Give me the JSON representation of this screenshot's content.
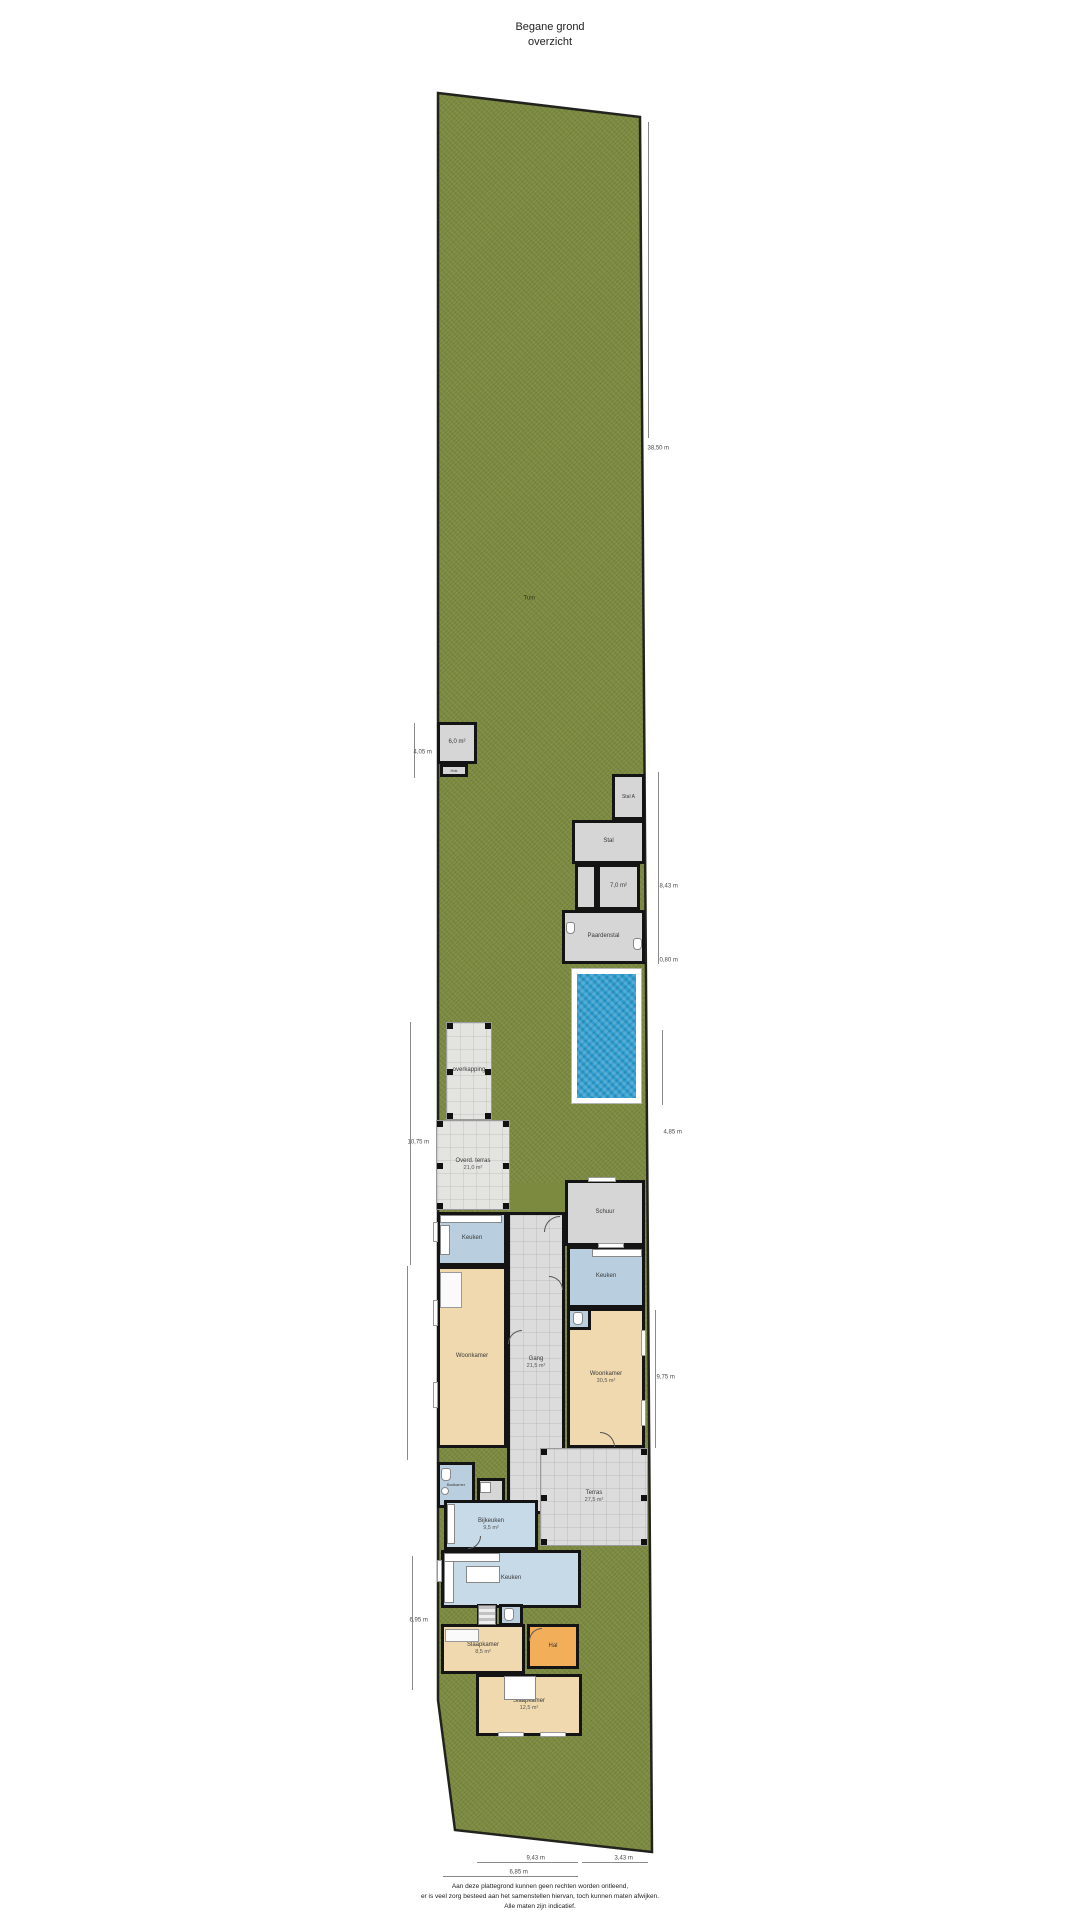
{
  "title": {
    "line1": "Begane grond",
    "line2": "overzicht"
  },
  "disclaimer": {
    "line1": "Aan deze plattegrond kunnen geen rechten worden ontleend,",
    "line2": "er is veel zorg besteed aan het samenstellen hiervan, toch kunnen maten afwijken.",
    "line3": "Alle maten zijn indicatief."
  },
  "colors": {
    "grass": "#7b8a3f",
    "water": "#2f9fd0",
    "wall": "#141414",
    "tan": "#f0d9ae",
    "blue": "#b9cfdf",
    "blueLight": "#c6dae8",
    "orange": "#f2ae58",
    "gray": "#d6d6d6",
    "tile": "#dcdcdc",
    "deck": "#ffffff"
  },
  "plot": {
    "points": "438,93 640,117 652,1852 455,1830 438,1700",
    "clip": "polygon(438px 93px, 640px 117px, 652px 1852px, 455px 1830px, 438px 1700px)"
  },
  "garden_label": {
    "text": "Tuin",
    "x": 524,
    "y": 596
  },
  "pool": {
    "n": "zwembad",
    "x": 571,
    "y": 968,
    "w": 71,
    "h": 136
  },
  "patches": [
    {
      "n": "gras-binnenplaats",
      "x": 511,
      "y": 1183,
      "w": 54,
      "h": 32
    }
  ],
  "verandas": [
    {
      "n": "overkapping",
      "x": 446,
      "y": 1022,
      "w": 46,
      "h": 98,
      "l1": "overkapping"
    },
    {
      "n": "overdekt-terras",
      "x": 436,
      "y": 1120,
      "w": 74,
      "h": 90,
      "l1": "Overd. terras",
      "l2": "21,0 m²"
    }
  ],
  "rooms": [
    {
      "n": "schuur-klein",
      "f": "gray",
      "x": 437,
      "y": 722,
      "w": 40,
      "h": 42,
      "l1": "6,0 m²"
    },
    {
      "n": "hok-klein",
      "f": "gray",
      "x": 440,
      "y": 764,
      "w": 28,
      "h": 13,
      "l1": "Hok",
      "fs": 4
    },
    {
      "n": "stal-a",
      "f": "gray",
      "x": 612,
      "y": 774,
      "w": 33,
      "h": 46,
      "l1": "Stal A",
      "fs": 5
    },
    {
      "n": "stal-b",
      "f": "gray",
      "x": 572,
      "y": 820,
      "w": 73,
      "h": 44,
      "l1": "Stal"
    },
    {
      "n": "hok-1",
      "f": "gray",
      "x": 575,
      "y": 864,
      "w": 22,
      "h": 46
    },
    {
      "n": "hok-2",
      "f": "gray",
      "x": 597,
      "y": 864,
      "w": 43,
      "h": 46,
      "l1": "7,0 m²"
    },
    {
      "n": "paardenstal",
      "f": "gray",
      "x": 562,
      "y": 910,
      "w": 83,
      "h": 54,
      "l1": "Paardenstal"
    },
    {
      "n": "schuur-achter",
      "f": "gray",
      "x": 565,
      "y": 1180,
      "w": 80,
      "h": 66,
      "l1": "Schuur"
    },
    {
      "n": "keuken-links",
      "f": "blue",
      "x": 437,
      "y": 1212,
      "w": 70,
      "h": 54,
      "l1": "Keuken"
    },
    {
      "n": "woonkamer-links",
      "f": "tan",
      "x": 437,
      "y": 1266,
      "w": 70,
      "h": 182,
      "l1": "Woonkamer"
    },
    {
      "n": "gang",
      "f": "tile",
      "t": "tilebg",
      "x": 507,
      "y": 1212,
      "w": 58,
      "h": 302,
      "l1": "Gang",
      "l2": "21,5 m²"
    },
    {
      "n": "keuken-rechts",
      "f": "blue",
      "x": 567,
      "y": 1246,
      "w": 78,
      "h": 62,
      "l1": "Keuken"
    },
    {
      "n": "woonkamer-rechts",
      "f": "tan",
      "x": 567,
      "y": 1308,
      "w": 78,
      "h": 140,
      "l1": "Woonkamer",
      "l2": "30,5 m²"
    },
    {
      "n": "toilet-rechts",
      "f": "blue",
      "x": 567,
      "y": 1308,
      "w": 24,
      "h": 22
    },
    {
      "n": "badkamer-links",
      "f": "blue",
      "x": 437,
      "y": 1462,
      "w": 38,
      "h": 46,
      "l1": "Badkamer",
      "fs": 4
    },
    {
      "n": "kast-cv",
      "f": "gray",
      "x": 477,
      "y": 1478,
      "w": 28,
      "h": 30
    },
    {
      "n": "bijkeuken",
      "f": "blueLight",
      "x": 444,
      "y": 1500,
      "w": 94,
      "h": 50,
      "l1": "Bijkeuken",
      "l2": "9,5 m²"
    },
    {
      "n": "terras-achter",
      "f": "tile",
      "t": "tilebg",
      "x": 540,
      "y": 1448,
      "w": 108,
      "h": 98,
      "l1": "Terras",
      "l2": "27,5 m²",
      "thin": true,
      "posts": true
    },
    {
      "n": "keuken-onder",
      "f": "blueLight",
      "x": 441,
      "y": 1550,
      "w": 140,
      "h": 58,
      "l1": "Keuken"
    },
    {
      "n": "trap-kamer",
      "f": "tile",
      "x": 477,
      "y": 1604,
      "w": 20,
      "h": 22
    },
    {
      "n": "toilet-onder",
      "f": "blue",
      "x": 499,
      "y": 1604,
      "w": 24,
      "h": 22
    },
    {
      "n": "slaapkamer-1",
      "f": "tan",
      "x": 441,
      "y": 1624,
      "w": 84,
      "h": 50,
      "l1": "Slaapkamer",
      "l2": "8,5 m²"
    },
    {
      "n": "hal",
      "f": "orange",
      "x": 527,
      "y": 1624,
      "w": 52,
      "h": 45,
      "l1": "Hal"
    },
    {
      "n": "slaapkamer-2",
      "f": "tan",
      "x": 476,
      "y": 1674,
      "w": 106,
      "h": 62,
      "l1": "Slaapkamer",
      "l2": "12,5 m²"
    }
  ],
  "fixtures": [
    {
      "k": "counter",
      "x": 440,
      "y": 1215,
      "w": 62,
      "h": 8
    },
    {
      "k": "counter",
      "x": 440,
      "y": 1225,
      "w": 10,
      "h": 30
    },
    {
      "k": "counter",
      "x": 592,
      "y": 1249,
      "w": 50,
      "h": 8
    },
    {
      "k": "counter",
      "x": 447,
      "y": 1504,
      "w": 8,
      "h": 40
    },
    {
      "k": "counter",
      "x": 444,
      "y": 1553,
      "w": 10,
      "h": 50
    },
    {
      "k": "counter",
      "x": 444,
      "y": 1553,
      "w": 56,
      "h": 9
    },
    {
      "k": "island",
      "x": 466,
      "y": 1566,
      "w": 34,
      "h": 17
    },
    {
      "k": "wc",
      "x": 573,
      "y": 1312,
      "w": 10,
      "h": 13
    },
    {
      "k": "wc",
      "x": 441,
      "y": 1468,
      "w": 10,
      "h": 13
    },
    {
      "k": "sink",
      "x": 441,
      "y": 1487,
      "w": 8,
      "h": 8
    },
    {
      "k": "wc",
      "x": 504,
      "y": 1608,
      "w": 10,
      "h": 13
    },
    {
      "k": "wc",
      "x": 566,
      "y": 922,
      "w": 9,
      "h": 12
    },
    {
      "k": "wc",
      "x": 633,
      "y": 938,
      "w": 9,
      "h": 12
    },
    {
      "k": "stairs",
      "x": 478,
      "y": 1605,
      "w": 18,
      "h": 20
    },
    {
      "k": "bed",
      "x": 504,
      "y": 1676,
      "w": 32,
      "h": 24
    },
    {
      "k": "furn",
      "x": 445,
      "y": 1629,
      "w": 34,
      "h": 13
    },
    {
      "k": "furn",
      "x": 440,
      "y": 1272,
      "w": 22,
      "h": 36
    },
    {
      "k": "washer",
      "x": 480,
      "y": 1482,
      "w": 11,
      "h": 11
    }
  ],
  "windows": [
    {
      "x": 433,
      "y": 1222,
      "w": 5,
      "h": 20
    },
    {
      "x": 433,
      "y": 1300,
      "w": 5,
      "h": 26
    },
    {
      "x": 433,
      "y": 1382,
      "w": 5,
      "h": 26
    },
    {
      "x": 641,
      "y": 1330,
      "w": 5,
      "h": 26
    },
    {
      "x": 641,
      "y": 1400,
      "w": 5,
      "h": 26
    },
    {
      "x": 598,
      "y": 1243,
      "w": 26,
      "h": 5
    },
    {
      "x": 588,
      "y": 1177,
      "w": 28,
      "h": 5
    },
    {
      "x": 437,
      "y": 1560,
      "w": 5,
      "h": 22
    },
    {
      "x": 498,
      "y": 1732,
      "w": 26,
      "h": 5
    },
    {
      "x": 540,
      "y": 1732,
      "w": 26,
      "h": 5
    }
  ],
  "doors": [
    {
      "x": 544,
      "y": 1216,
      "s": 16,
      "r": 0
    },
    {
      "x": 549,
      "y": 1276,
      "s": 14,
      "r": 90
    },
    {
      "x": 508,
      "y": 1330,
      "s": 14,
      "r": 0
    },
    {
      "x": 468,
      "y": 1536,
      "s": 13,
      "r": 180
    },
    {
      "x": 600,
      "y": 1432,
      "s": 15,
      "r": 90
    },
    {
      "x": 529,
      "y": 1628,
      "s": 13,
      "r": 0
    }
  ],
  "dimensions": {
    "vlines": [
      {
        "x": 414,
        "y1": 723,
        "y2": 778
      },
      {
        "x": 648,
        "y1": 122,
        "y2": 438
      },
      {
        "x": 658,
        "y1": 772,
        "y2": 964
      },
      {
        "x": 662,
        "y1": 1030,
        "y2": 1105
      },
      {
        "x": 410,
        "y1": 1022,
        "y2": 1265
      },
      {
        "x": 407,
        "y1": 1266,
        "y2": 1460
      },
      {
        "x": 655,
        "y1": 1310,
        "y2": 1448
      },
      {
        "x": 412,
        "y1": 1556,
        "y2": 1690
      }
    ],
    "hlines": [
      {
        "y": 1862,
        "x1": 477,
        "x2": 578
      },
      {
        "y": 1862,
        "x1": 582,
        "x2": 648
      },
      {
        "y": 1876,
        "x1": 443,
        "x2": 578
      }
    ],
    "labels": [
      {
        "t": "38,50 m",
        "x": 648,
        "y": 446
      },
      {
        "t": "4,05 m",
        "x": 414,
        "y": 750
      },
      {
        "t": "8,43 m",
        "x": 660,
        "y": 884
      },
      {
        "t": "0,80 m",
        "x": 660,
        "y": 958
      },
      {
        "t": "4,85 m",
        "x": 664,
        "y": 1130
      },
      {
        "t": "10,75 m",
        "x": 408,
        "y": 1140
      },
      {
        "t": "9,75 m",
        "x": 657,
        "y": 1375
      },
      {
        "t": "6,95 m",
        "x": 410,
        "y": 1618
      },
      {
        "t": "9,43 m",
        "x": 527,
        "y": 1856
      },
      {
        "t": "3,43 m",
        "x": 615,
        "y": 1856
      },
      {
        "t": "6,85 m",
        "x": 510,
        "y": 1870
      }
    ]
  }
}
